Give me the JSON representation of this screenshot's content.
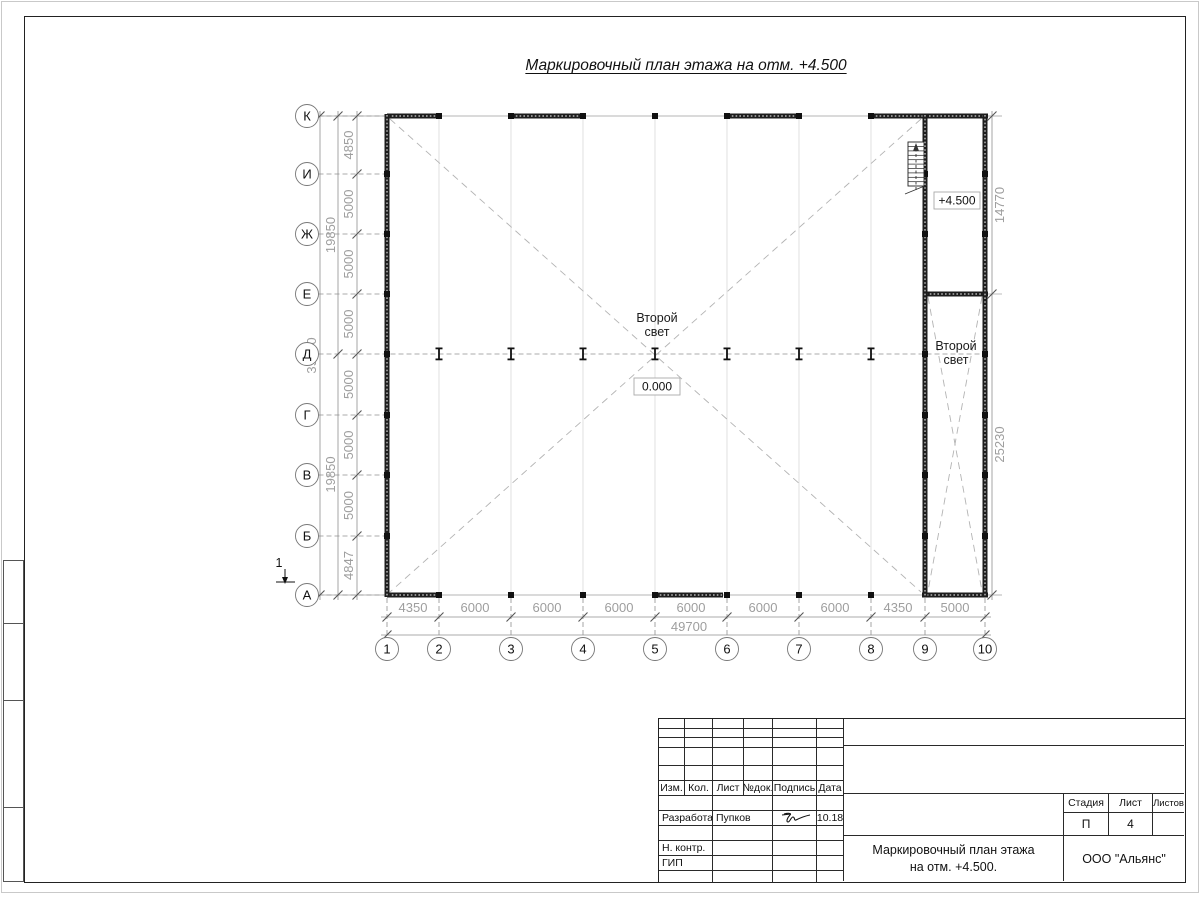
{
  "sheet_title": "Маркировочный план этажа на отм. +4.500",
  "plan": {
    "row_axes": [
      "К",
      "И",
      "Ж",
      "Е",
      "Д",
      "Г",
      "В",
      "Б",
      "А"
    ],
    "col_axes": [
      "1",
      "2",
      "3",
      "4",
      "5",
      "6",
      "7",
      "8",
      "9",
      "10"
    ],
    "dims_bottom": [
      "4350",
      "6000",
      "6000",
      "6000",
      "6000",
      "6000",
      "6000",
      "4350",
      "5000"
    ],
    "dim_bottom_total": "49700",
    "dims_left": [
      "4850",
      "5000",
      "5000",
      "5000",
      "5000",
      "5000",
      "5000",
      "4847"
    ],
    "dims_left_mid": [
      "19850",
      "19850"
    ],
    "dim_left_total": "39700",
    "dims_right": [
      "14770",
      "25230"
    ],
    "labels": {
      "second_light_line1": "Второй",
      "second_light_line2": "свет",
      "elev_zero": "0.000",
      "elev_450": "+4.500",
      "section_mark": "1"
    }
  },
  "title_block": {
    "cols": [
      "Изм.",
      "Кол.",
      "Лист",
      "№док.",
      "Подпись",
      "Дата"
    ],
    "developed_label": "Разработал",
    "developed_name": "Пупков",
    "developed_date": "10.18",
    "ncontr_label": "Н. контр.",
    "gip_label": "ГИП",
    "stage_label": "Стадия",
    "sheet_label": "Лист",
    "sheets_label": "Листов",
    "stage_value": "П",
    "sheet_value": "4",
    "doc_title_line1": "Маркировочный план этажа",
    "doc_title_line2": "на отм. +4.500.",
    "company": "ООО \"Альянс\""
  },
  "colors": {
    "wall": "#1d1d1d",
    "dim_text": "#9e9e9e",
    "dim_line": "#8f8f8f",
    "axis_line": "#b5b5b5",
    "grid_line": "#d8d8d8"
  }
}
